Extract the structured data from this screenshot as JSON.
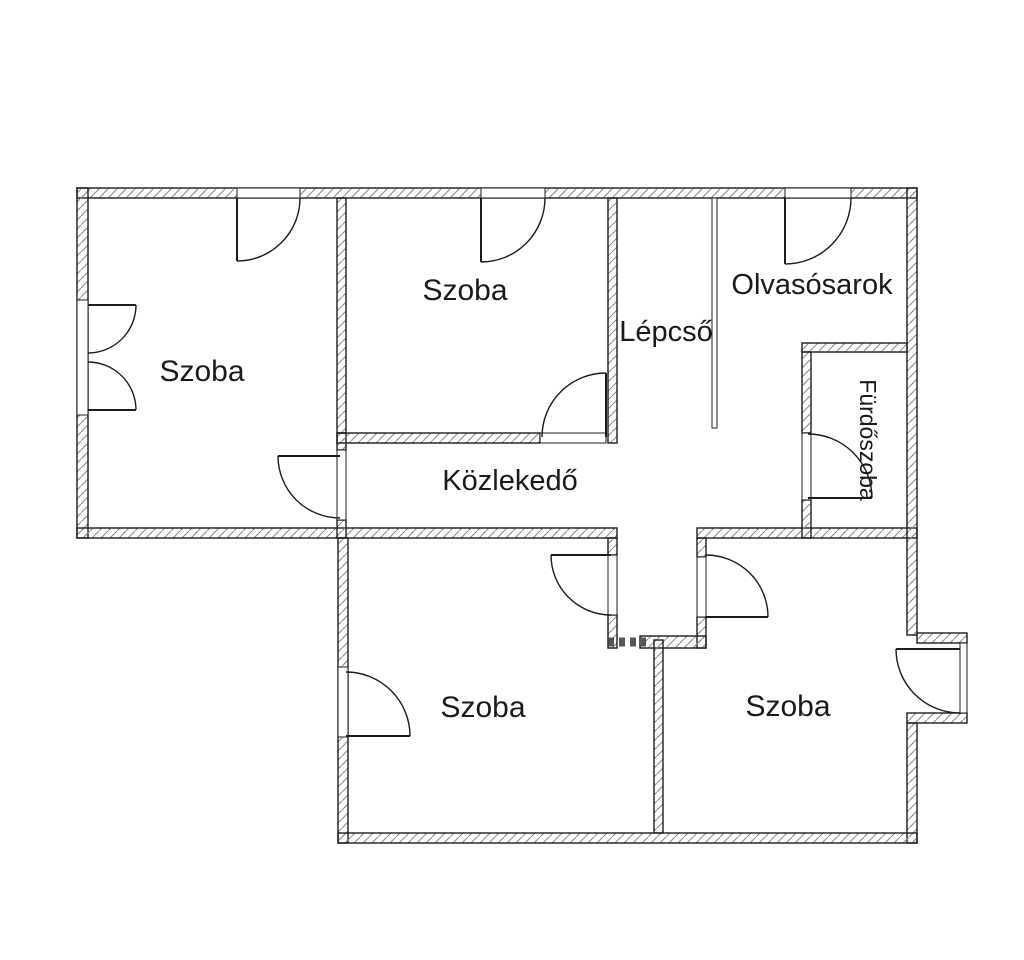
{
  "title": "Floor plan",
  "colors": {
    "background": "#ffffff",
    "wall_line": "#1c1c1c",
    "hatch": "#8c8c8c",
    "text": "#1a1a1a"
  },
  "rooms": [
    {
      "id": "szoba-top-left",
      "label": "Szoba"
    },
    {
      "id": "szoba-top-middle",
      "label": "Szoba"
    },
    {
      "id": "lepcso",
      "label": "Lépcső"
    },
    {
      "id": "olvasosarok",
      "label": "Olvasósarok"
    },
    {
      "id": "furdoszoba",
      "label": "Fürdőszoba"
    },
    {
      "id": "kozlekedo",
      "label": "Közlekedő"
    },
    {
      "id": "szoba-bottom-left",
      "label": "Szoba"
    },
    {
      "id": "szoba-bottom-right",
      "label": "Szoba"
    }
  ]
}
